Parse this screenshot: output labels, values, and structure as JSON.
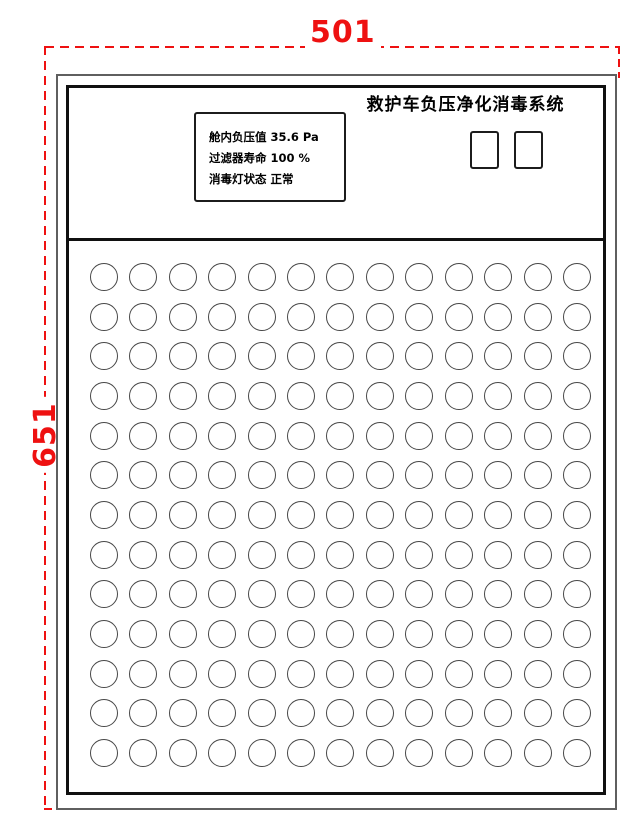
{
  "drawing": {
    "width_dimension": "501",
    "height_dimension": "651"
  },
  "panel": {
    "title": "救护车负压净化消毒系统",
    "display": {
      "lines": [
        "舱内负压值 35.6 Pa",
        "过滤器寿命 100 %",
        "消毒灯状态 正常"
      ]
    },
    "buttons": [
      {
        "name": "panel-button-1",
        "label": ""
      },
      {
        "name": "panel-button-2",
        "label": ""
      }
    ],
    "grid": {
      "rows": 13,
      "cols": 13
    }
  },
  "colors": {
    "dimension": "#ee1111",
    "panel_border": "#101010",
    "outer_border": "#5f5f5f",
    "circle_stroke": "#474747"
  }
}
